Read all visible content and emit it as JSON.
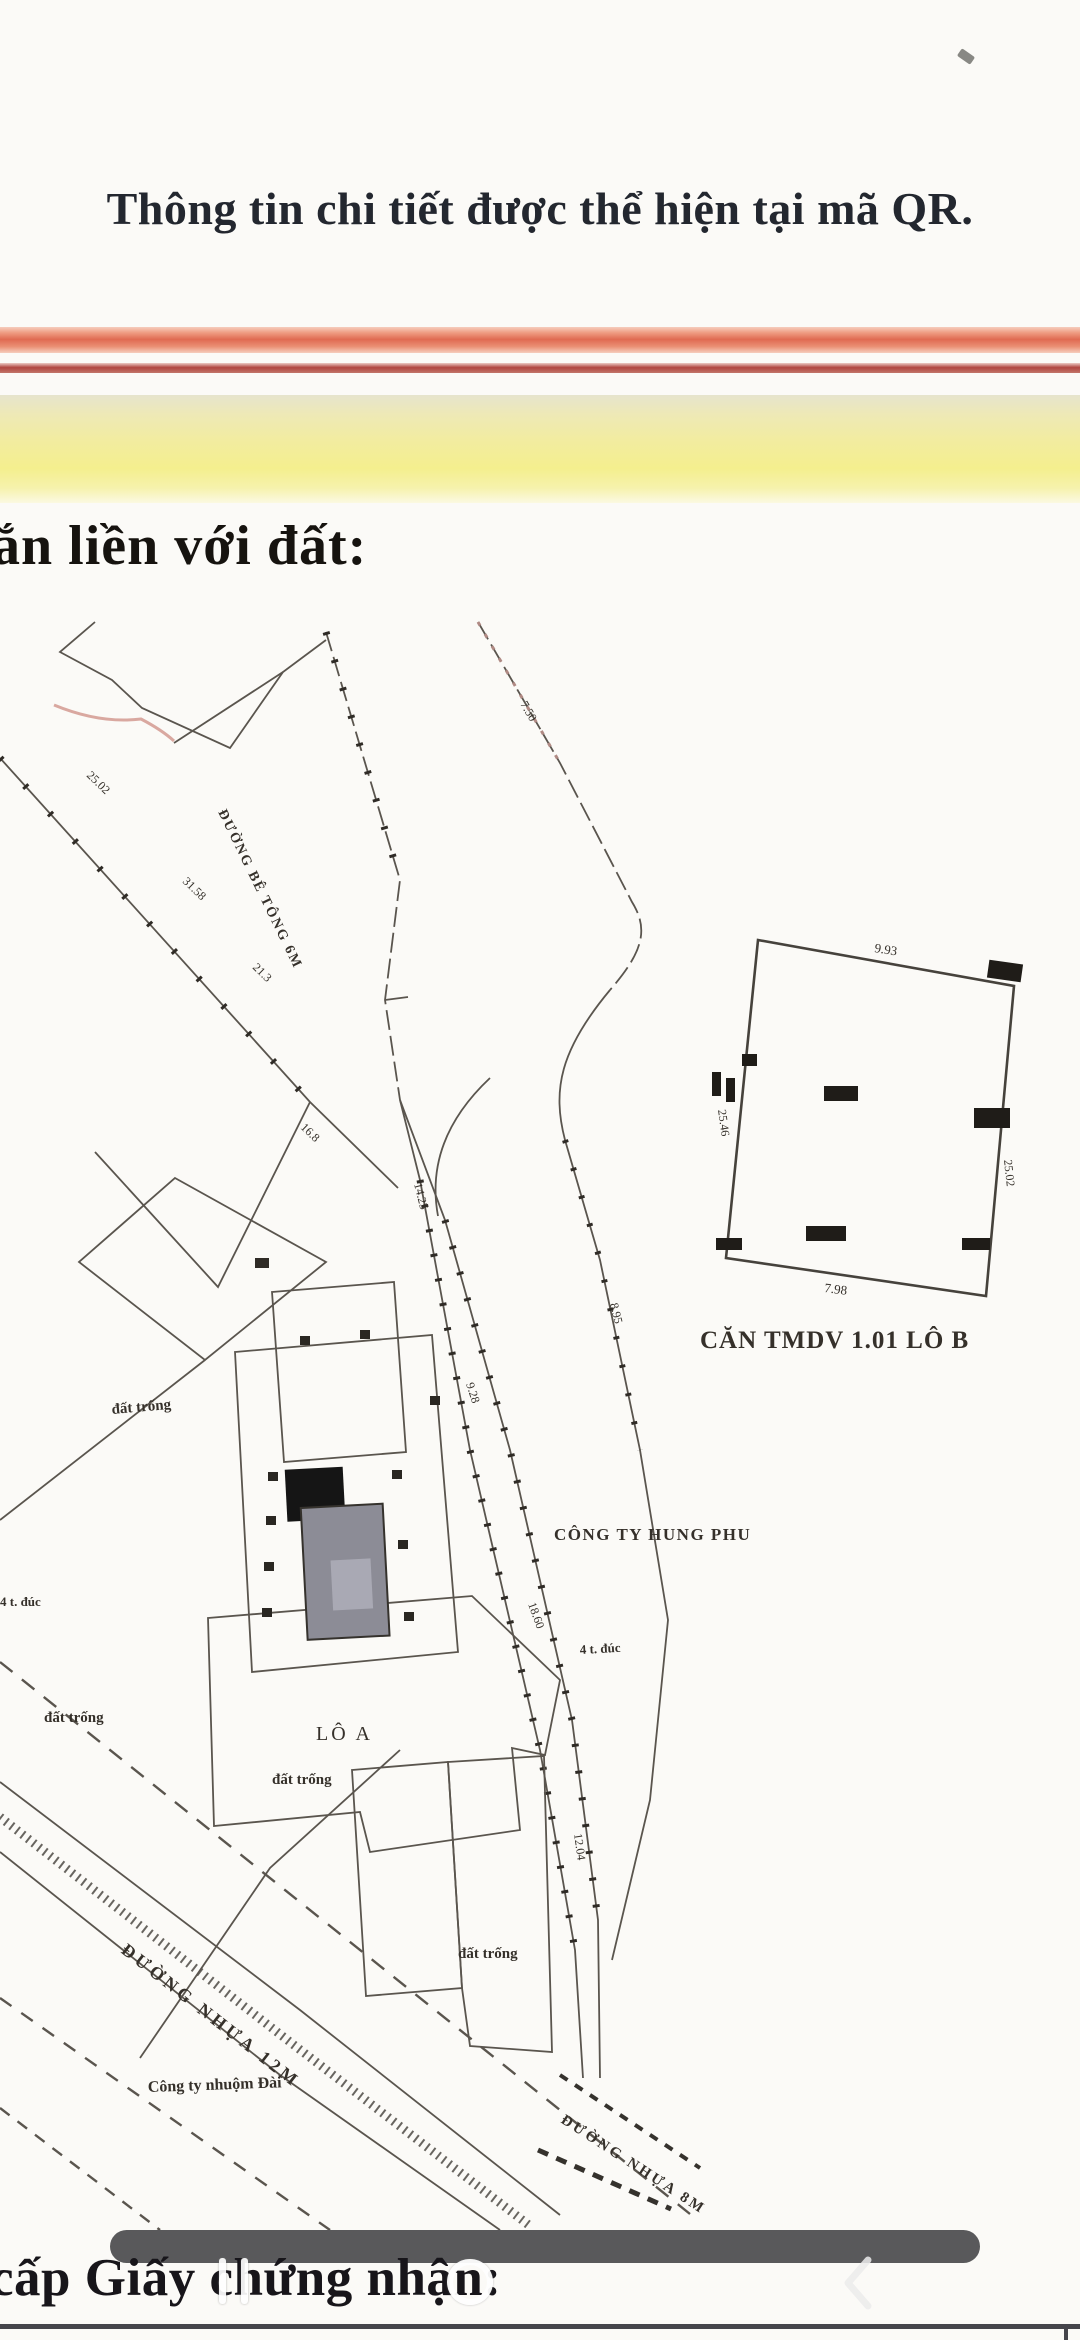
{
  "page": {
    "qr_note": "Thông tin chi tiết được thể hiện tại mã QR.",
    "heading": "ắn liền với đất:",
    "bottom_caption": "cấp Giấy chứng nhận:"
  },
  "map": {
    "labels": {
      "lot_a": "LÔ A",
      "company_right": "CÔNG TY HUNG PHU",
      "company_bottom": "Công ty nhuộm Đài",
      "vacant": "đất trống",
      "floors_note": "4 t. đúc",
      "road_name_main": "ĐƯỜNG NHỰA 12M",
      "road_name_secondary": "ĐƯỜNG NHỰA 8M",
      "road_name_mouth": "ĐƯỜNG BÊ TÔNG 6M"
    },
    "dims": [
      "25.02",
      "31.58",
      "14.25",
      "9.28",
      "18.60",
      "12.04",
      "8.95",
      "7.50",
      "21.3",
      "16.8"
    ],
    "inset": {
      "caption": "CĂN TMDV 1.01 LÔ B",
      "dim_top": "9.93",
      "dim_bottom": "7.98",
      "dim_left": "25.46",
      "dim_right": "25.02"
    }
  },
  "nav": {
    "recents": "recents",
    "home": "home",
    "back": "back"
  },
  "colors": {
    "band_red": "#e06a52",
    "band_red_thin": "#b0453f",
    "band_yellow": "#f4ef8e",
    "redact_bar": "#59595b",
    "map_line": "#5a554e",
    "building_dark": "#151515",
    "building_gray": "#8c8c96"
  }
}
